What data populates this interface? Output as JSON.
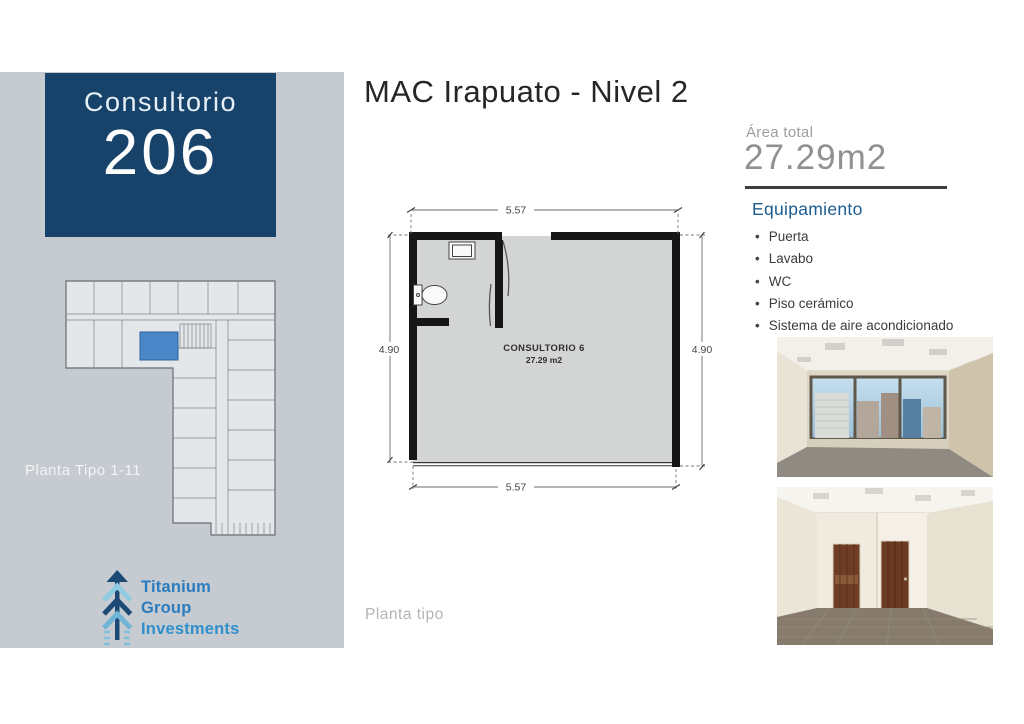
{
  "header": {
    "title": "MAC Irapuato - Nivel 2"
  },
  "sidebar": {
    "unit_card": {
      "label": "Consultorio",
      "number": "206"
    },
    "mini_plan_caption": "Planta Tipo 1-11",
    "logo": {
      "line1": "Titanium",
      "line2": "Group",
      "line3": "Investments"
    }
  },
  "floorplan": {
    "caption": "Planta tipo",
    "room_label": "CONSULTORIO 6",
    "room_area": "27.29 m2",
    "dimensions": {
      "top": "5.57",
      "bottom": "5.57",
      "left": "4.90",
      "right": "4.90"
    }
  },
  "details": {
    "area_label": "Área total",
    "area_value": "27.29m2",
    "equipment_heading": "Equipamiento",
    "equipment_items": [
      "Puerta",
      "Lavabo",
      "WC",
      "Piso cerámico",
      "Sistema de aire acondicionado"
    ]
  },
  "colors": {
    "accent-navy": "#17436a",
    "sidebar-gray": "#c6cbd1",
    "highlight-blue": "#4a87c8",
    "equipment-blue": "#1b5d92",
    "logo-blue": "#2a7cbf",
    "divider-dark": "#3e3e3e",
    "muted-gray": "#9e9e9e",
    "area-value-gray": "#8f9193",
    "title-dark": "#262626"
  }
}
